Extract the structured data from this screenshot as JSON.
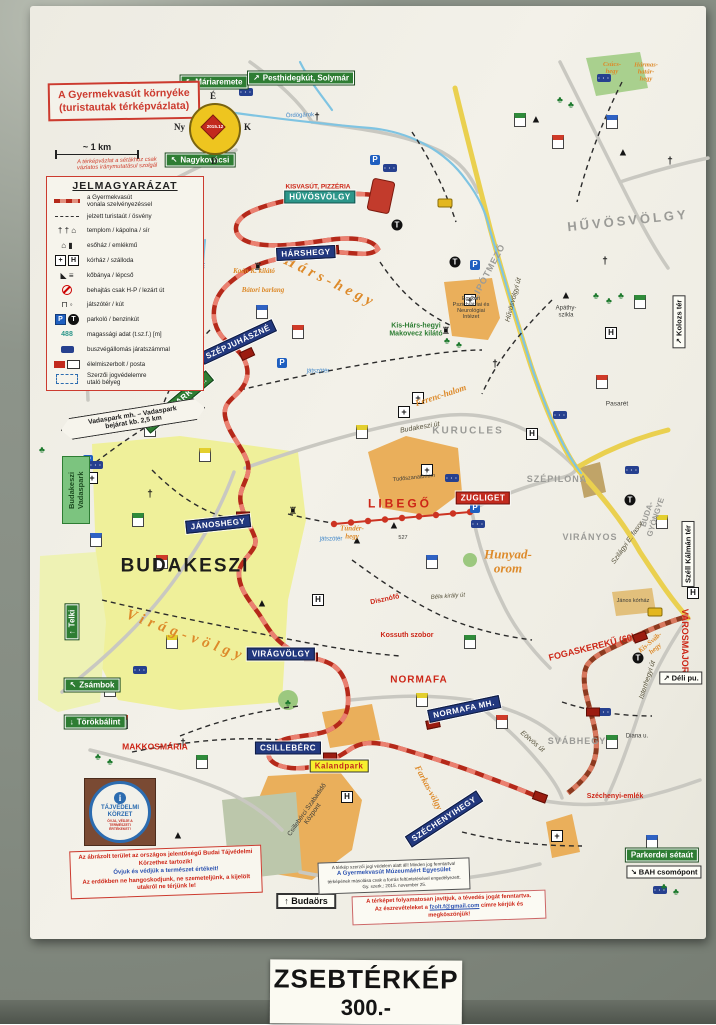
{
  "price": {
    "line1": "ZSEBTÉRKÉP",
    "line2": "300.-"
  },
  "title_box": {
    "line1": "A Gyermekvasút környéke",
    "line2": "(turistautak térképvázlata)"
  },
  "note": "A térképvázlat a sétákhoz csak\nvázlatos iránymutatásul szolgál",
  "scale_label": "~ 1 km",
  "compass": {
    "n": "É",
    "e": "K",
    "s": "D",
    "w": "Ny",
    "date": "2015.12"
  },
  "legend": {
    "title": "JELMAGYARÁZAT",
    "items": [
      {
        "type": "rail",
        "label": "a Gyermekvasút\nvonala szelvényezéssel"
      },
      {
        "type": "trail",
        "label": "jelzett turistaút / ösvény"
      },
      {
        "type": "church",
        "label": "templom / kápolna / sír"
      },
      {
        "type": "shelter",
        "label": "esőház / emlékmű"
      },
      {
        "type": "hospital",
        "label": "kórház / szálloda"
      },
      {
        "type": "quarry",
        "label": "kőbánya / lépcső"
      },
      {
        "type": "restricted",
        "label": "behajtás csak H-P / lezárt út"
      },
      {
        "type": "playground",
        "label": "játszótér / kút"
      },
      {
        "type": "parking",
        "label": "parkoló / benzinkút"
      },
      {
        "type": "elevation",
        "sample": "488",
        "label": "magassági adat (t.sz.f.) [m]"
      },
      {
        "type": "bus",
        "label": "buszvégállomás járatszámmal"
      },
      {
        "type": "shop",
        "label": "élelmiszerbolt / posta"
      },
      {
        "type": "stamp",
        "label": "Szerzői jogvédelemre\nutaló bélyeg"
      }
    ]
  },
  "callout": "Vadaspark mh. – Vadaspark\nbejárat kb. 2,5 km",
  "vadaspark_sign": "Budakeszi\nVadaspark",
  "stations": [
    {
      "t": "HŰVÖSVÖLGY",
      "x": 320,
      "y": 197,
      "v": "teal"
    },
    {
      "t": "HÁRSHEGY",
      "x": 306,
      "y": 253,
      "r": -3
    },
    {
      "t": "SZÉPJUHÁSZNÉ",
      "x": 238,
      "y": 342,
      "r": -25
    },
    {
      "t": "VADASPARK MH.",
      "x": 178,
      "y": 402,
      "r": -40,
      "v": "green"
    },
    {
      "t": "JÁNOSHEGY",
      "x": 218,
      "y": 524,
      "r": -6
    },
    {
      "t": "VIRÁGVÖLGY",
      "x": 281,
      "y": 654
    },
    {
      "t": "NORMAFA MH.",
      "x": 464,
      "y": 709,
      "r": -12
    },
    {
      "t": "CSILLEBÉRC",
      "x": 288,
      "y": 748
    },
    {
      "t": "SZÉCHENYIHEGY",
      "x": 444,
      "y": 819,
      "r": -33
    },
    {
      "t": "ZUGLIGET",
      "x": 483,
      "y": 498,
      "v": "red"
    },
    {
      "t": "Kalandpark",
      "x": 339,
      "y": 766,
      "v": "yellow"
    }
  ],
  "green_signs": [
    {
      "t": "Máriaremete",
      "a": "↖",
      "x": 214,
      "y": 82
    },
    {
      "t": "Pesthidegkút, Solymár",
      "a": "↗",
      "x": 301,
      "y": 78
    },
    {
      "t": "Nagykovácsi",
      "a": "↖",
      "x": 200,
      "y": 160
    },
    {
      "t": "Telki",
      "a": "↑",
      "x": 72,
      "y": 622,
      "r": -90
    },
    {
      "t": "Zsámbok",
      "a": "↖",
      "x": 92,
      "y": 685
    },
    {
      "t": "Törökbálint",
      "a": "↓",
      "x": 95,
      "y": 722
    },
    {
      "t": "Parkerdei sétaút",
      "a": "",
      "x": 662,
      "y": 855
    }
  ],
  "white_signs": [
    {
      "t": "Kolozs tér",
      "a": "↗",
      "x": 679,
      "y": 322,
      "r": -90
    },
    {
      "t": "Széll Kálmán tér",
      "a": "",
      "x": 688,
      "y": 554,
      "r": -90
    },
    {
      "t": "Déli pu.",
      "a": "↗",
      "x": 681,
      "y": 678
    },
    {
      "t": "BAH csomópont",
      "a": "↘",
      "x": 664,
      "y": 872
    },
    {
      "t": "Budaörs",
      "a": "↑",
      "x": 306,
      "y": 901,
      "v": "strong"
    }
  ],
  "labels": [
    {
      "t": "HŰVÖSVÖLGY",
      "x": 628,
      "y": 221,
      "c": "gray",
      "s": 13,
      "r": -6,
      "ls": 3
    },
    {
      "t": "LIPÓTMEZŐ",
      "x": 489,
      "y": 272,
      "c": "gray",
      "s": 9,
      "r": -62,
      "ls": 1
    },
    {
      "t": "KURUCLES",
      "x": 468,
      "y": 431,
      "c": "gray",
      "s": 10,
      "ls": 2
    },
    {
      "t": "SZÉPILONA",
      "x": 557,
      "y": 480,
      "c": "gray",
      "s": 9,
      "ls": 1
    },
    {
      "t": "VIRÁNYOS",
      "x": 590,
      "y": 538,
      "c": "gray",
      "s": 9,
      "ls": 1
    },
    {
      "t": "SVÁBHEGY",
      "x": 577,
      "y": 742,
      "c": "gray",
      "s": 9,
      "ls": 1
    },
    {
      "t": "BUDA-\nGYÖNGYE",
      "x": 652,
      "y": 516,
      "c": "gray",
      "s": 8,
      "r": -72
    },
    {
      "t": "BUDAKESZI",
      "x": 185,
      "y": 567,
      "c": "big",
      "s": 19,
      "ls": 2
    },
    {
      "t": "Hárs-hegy",
      "x": 330,
      "y": 282,
      "c": "orange",
      "s": 15,
      "r": 26,
      "ls": 4
    },
    {
      "t": "Virág-völgy",
      "x": 186,
      "y": 636,
      "c": "orange",
      "s": 15,
      "r": 20,
      "ls": 5
    },
    {
      "t": "Hunyad-\norom",
      "x": 508,
      "y": 562,
      "c": "orange",
      "s": 13
    },
    {
      "t": "Ferenc-halom",
      "x": 441,
      "y": 396,
      "c": "orange",
      "s": 9,
      "r": -18
    },
    {
      "t": "Kis-Sváb-\nhegy",
      "x": 653,
      "y": 646,
      "c": "orange",
      "s": 7,
      "r": -40
    },
    {
      "t": "Tündér-\nhegy",
      "x": 352,
      "y": 533,
      "c": "orange",
      "s": 7
    },
    {
      "t": "Farkas-völgy",
      "x": 428,
      "y": 788,
      "c": "orange",
      "s": 9,
      "r": 62
    },
    {
      "t": "Csúcs-\nhegy",
      "x": 612,
      "y": 68,
      "c": "orange",
      "s": 6.5
    },
    {
      "t": "Hármas-\nhatár-\nhegy",
      "x": 646,
      "y": 72,
      "c": "orange",
      "s": 6.5
    },
    {
      "t": "Kaán K. kilátó",
      "x": 254,
      "y": 272,
      "c": "orange",
      "s": 7
    },
    {
      "t": "Bátori barlang",
      "x": 263,
      "y": 291,
      "c": "orange",
      "s": 7
    },
    {
      "t": "Kis-Hárs-hegyi\nMakovecz kilátó",
      "x": 416,
      "y": 330,
      "c": "green",
      "s": 7
    },
    {
      "t": "KISVASÚT, PIZZÉRIA",
      "x": 318,
      "y": 187,
      "c": "red",
      "s": 6.5
    },
    {
      "t": "LIBEGŐ",
      "x": 400,
      "y": 504,
      "c": "red",
      "s": 12,
      "ls": 3
    },
    {
      "t": "FOGASKEREKŰ (60)",
      "x": 592,
      "y": 648,
      "c": "red",
      "s": 9,
      "r": -14
    },
    {
      "t": "VÁROSMAJOR",
      "x": 684,
      "y": 641,
      "c": "red",
      "s": 9,
      "r": 90
    },
    {
      "t": "NORMAFA",
      "x": 419,
      "y": 680,
      "c": "red",
      "s": 10,
      "ls": 1
    },
    {
      "t": "MAKKOSMÁRIA",
      "x": 155,
      "y": 747,
      "c": "red",
      "s": 8.5
    },
    {
      "t": "Kossuth szobor",
      "x": 407,
      "y": 636,
      "c": "red",
      "s": 7
    },
    {
      "t": "Disznófő",
      "x": 385,
      "y": 600,
      "c": "red",
      "s": 7,
      "r": -12
    },
    {
      "t": "Széchenyi-emlék",
      "x": 615,
      "y": 797,
      "c": "red",
      "s": 7
    },
    {
      "t": "Tüdőszanatórium",
      "x": 414,
      "y": 478,
      "c": "dark",
      "s": 5.5,
      "r": -6
    },
    {
      "t": "Csillebérci Szabadidő\nKözpont",
      "x": 310,
      "y": 812,
      "c": "dark",
      "s": 6.5,
      "r": -55
    },
    {
      "t": "Egykori\nPszichiátriai és\nNeurológiai\nIntézet",
      "x": 471,
      "y": 308,
      "c": "dark",
      "s": 5.5
    },
    {
      "t": "Apáthy-\nszikla",
      "x": 566,
      "y": 312,
      "c": "dark",
      "s": 6
    },
    {
      "t": "Pasarét",
      "x": 617,
      "y": 404,
      "c": "dark",
      "s": 6.5
    },
    {
      "t": "János kórház",
      "x": 633,
      "y": 601,
      "c": "dark",
      "s": 5.5
    },
    {
      "t": "Diana u.",
      "x": 637,
      "y": 737,
      "c": "dark",
      "s": 6
    },
    {
      "t": "527",
      "x": 403,
      "y": 538,
      "c": "dark",
      "s": 5.5
    },
    {
      "t": "Ördögárok",
      "x": 300,
      "y": 116,
      "c": "blue",
      "s": 6,
      "r": -2
    },
    {
      "t": "Kis-Ördögárok",
      "x": 201,
      "y": 282,
      "c": "blue",
      "s": 6,
      "r": -80
    },
    {
      "t": "játszótér",
      "x": 318,
      "y": 372,
      "c": "blue",
      "s": 6
    },
    {
      "t": "játszótér",
      "x": 331,
      "y": 540,
      "c": "blue",
      "s": 6
    },
    {
      "t": "Hűvösvölgyi út",
      "x": 514,
      "y": 300,
      "c": "road",
      "s": 7,
      "r": -75
    },
    {
      "t": "Szilágyi E. fasor",
      "x": 628,
      "y": 543,
      "c": "road",
      "s": 7,
      "r": -55
    },
    {
      "t": "Budakeszi út",
      "x": 420,
      "y": 428,
      "c": "road",
      "s": 7,
      "r": -10
    },
    {
      "t": "Istenhegyi út",
      "x": 648,
      "y": 680,
      "c": "road",
      "s": 7,
      "r": -72
    },
    {
      "t": "Eötvös út",
      "x": 532,
      "y": 742,
      "c": "road",
      "s": 7,
      "r": 40
    },
    {
      "t": "Béla király út",
      "x": 448,
      "y": 597,
      "c": "road",
      "s": 6,
      "r": -4
    }
  ],
  "icons": [
    {
      "k": "hospital",
      "g": "+",
      "x": 418,
      "y": 398
    },
    {
      "k": "hospital",
      "g": "+",
      "x": 404,
      "y": 412
    },
    {
      "k": "hospital",
      "g": "+",
      "x": 427,
      "y": 470
    },
    {
      "k": "hospital",
      "g": "+",
      "x": 470,
      "y": 300
    },
    {
      "k": "hospital",
      "g": "+",
      "x": 92,
      "y": 478
    },
    {
      "k": "hospital",
      "g": "+",
      "x": 557,
      "y": 836
    },
    {
      "k": "hotel",
      "g": "H",
      "x": 318,
      "y": 600
    },
    {
      "k": "hotel",
      "g": "H",
      "x": 532,
      "y": 434
    },
    {
      "k": "hotel",
      "g": "H",
      "x": 347,
      "y": 797
    },
    {
      "k": "hotel",
      "g": "H",
      "x": 611,
      "y": 333
    },
    {
      "k": "hotel",
      "g": "H",
      "x": 693,
      "y": 593
    },
    {
      "k": "parking",
      "g": "P",
      "x": 375,
      "y": 160
    },
    {
      "k": "parking",
      "g": "P",
      "x": 282,
      "y": 363
    },
    {
      "k": "parking",
      "g": "P",
      "x": 88,
      "y": 460
    },
    {
      "k": "parking",
      "g": "P",
      "x": 475,
      "y": 508
    },
    {
      "k": "parking",
      "g": "P",
      "x": 475,
      "y": 265
    },
    {
      "k": "fuel",
      "g": "T",
      "x": 397,
      "y": 225
    },
    {
      "k": "fuel",
      "g": "T",
      "x": 455,
      "y": 262
    },
    {
      "k": "fuel",
      "g": "T",
      "x": 630,
      "y": 500
    },
    {
      "k": "fuel",
      "g": "T",
      "x": 638,
      "y": 658
    },
    {
      "k": "bus",
      "g": "",
      "x": 246,
      "y": 92
    },
    {
      "k": "bus",
      "g": "",
      "x": 390,
      "y": 168
    },
    {
      "k": "bus",
      "g": "",
      "x": 452,
      "y": 478
    },
    {
      "k": "bus",
      "g": "",
      "x": 478,
      "y": 524
    },
    {
      "k": "bus",
      "g": "",
      "x": 560,
      "y": 415
    },
    {
      "k": "bus",
      "g": "",
      "x": 632,
      "y": 470
    },
    {
      "k": "bus",
      "g": "",
      "x": 604,
      "y": 78
    },
    {
      "k": "bus",
      "g": "",
      "x": 96,
      "y": 465
    },
    {
      "k": "bus",
      "g": "",
      "x": 140,
      "y": 670
    },
    {
      "k": "bus",
      "g": "",
      "x": 342,
      "y": 882
    },
    {
      "k": "bus",
      "g": "",
      "x": 604,
      "y": 712
    },
    {
      "k": "bus",
      "g": "",
      "x": 660,
      "y": 890
    },
    {
      "k": "tram",
      "g": "",
      "x": 445,
      "y": 203
    },
    {
      "k": "tram",
      "g": "",
      "x": 655,
      "y": 612
    },
    {
      "k": "church",
      "g": "†",
      "x": 317,
      "y": 118
    },
    {
      "k": "church",
      "g": "†",
      "x": 150,
      "y": 495
    },
    {
      "k": "church",
      "g": "†",
      "x": 183,
      "y": 744
    },
    {
      "k": "church",
      "g": "†",
      "x": 605,
      "y": 262
    },
    {
      "k": "church",
      "g": "†",
      "x": 495,
      "y": 365
    },
    {
      "k": "church",
      "g": "†",
      "x": 670,
      "y": 162
    },
    {
      "k": "peak",
      "g": "▲",
      "x": 394,
      "y": 526
    },
    {
      "k": "peak",
      "g": "▲",
      "x": 357,
      "y": 541
    },
    {
      "k": "peak",
      "g": "▲",
      "x": 566,
      "y": 296
    },
    {
      "k": "peak",
      "g": "▲",
      "x": 262,
      "y": 604
    },
    {
      "k": "peak",
      "g": "▲",
      "x": 623,
      "y": 153
    },
    {
      "k": "peak",
      "g": "▲",
      "x": 178,
      "y": 836
    },
    {
      "k": "peak",
      "g": "▲",
      "x": 536,
      "y": 120
    },
    {
      "k": "tower",
      "g": "♜",
      "x": 293,
      "y": 512
    },
    {
      "k": "tower",
      "g": "♜",
      "x": 258,
      "y": 268
    },
    {
      "k": "tower",
      "g": "♜",
      "x": 446,
      "y": 332
    },
    {
      "k": "tree",
      "g": "♣",
      "x": 596,
      "y": 296
    },
    {
      "k": "tree",
      "g": "♣",
      "x": 609,
      "y": 301
    },
    {
      "k": "tree",
      "g": "♣",
      "x": 621,
      "y": 296
    },
    {
      "k": "tree",
      "g": "♣",
      "x": 447,
      "y": 341
    },
    {
      "k": "tree",
      "g": "♣",
      "x": 459,
      "y": 345
    },
    {
      "k": "tree",
      "g": "♣",
      "x": 42,
      "y": 450
    },
    {
      "k": "tree",
      "g": "♣",
      "x": 98,
      "y": 757
    },
    {
      "k": "tree",
      "g": "♣",
      "x": 110,
      "y": 762
    },
    {
      "k": "tree",
      "g": "♣",
      "x": 288,
      "y": 703
    },
    {
      "k": "tree",
      "g": "♣",
      "x": 664,
      "y": 887
    },
    {
      "k": "tree",
      "g": "♣",
      "x": 676,
      "y": 892
    },
    {
      "k": "tree",
      "g": "♣",
      "x": 560,
      "y": 100
    },
    {
      "k": "tree",
      "g": "♣",
      "x": 571,
      "y": 105
    },
    {
      "k": "tree",
      "g": "♣",
      "x": 358,
      "y": 866
    }
  ],
  "flags": [
    {
      "x": 150,
      "y": 430,
      "c": "#d03a28"
    },
    {
      "x": 205,
      "y": 455,
      "c": "#e3cf2e"
    },
    {
      "x": 138,
      "y": 520,
      "c": "#2f8b3a"
    },
    {
      "x": 162,
      "y": 562,
      "c": "#d03a28"
    },
    {
      "x": 96,
      "y": 540,
      "c": "#2f62c4"
    },
    {
      "x": 520,
      "y": 120,
      "c": "#2f8b3a"
    },
    {
      "x": 558,
      "y": 142,
      "c": "#d03a28"
    },
    {
      "x": 612,
      "y": 122,
      "c": "#2f62c4"
    },
    {
      "x": 640,
      "y": 302,
      "c": "#2f8b3a"
    },
    {
      "x": 602,
      "y": 382,
      "c": "#d03a28"
    },
    {
      "x": 662,
      "y": 522,
      "c": "#e3cf2e"
    },
    {
      "x": 470,
      "y": 642,
      "c": "#2f8b3a"
    },
    {
      "x": 432,
      "y": 562,
      "c": "#2f62c4"
    },
    {
      "x": 362,
      "y": 432,
      "c": "#e3cf2e"
    },
    {
      "x": 298,
      "y": 332,
      "c": "#d03a28"
    },
    {
      "x": 262,
      "y": 312,
      "c": "#2f62c4"
    },
    {
      "x": 172,
      "y": 642,
      "c": "#e3cf2e"
    },
    {
      "x": 122,
      "y": 722,
      "c": "#d03a28"
    },
    {
      "x": 202,
      "y": 762,
      "c": "#2f8b3a"
    },
    {
      "x": 422,
      "y": 700,
      "c": "#e3cf2e"
    },
    {
      "x": 502,
      "y": 722,
      "c": "#d03a28"
    },
    {
      "x": 612,
      "y": 742,
      "c": "#2f8b3a"
    },
    {
      "x": 652,
      "y": 842,
      "c": "#2f62c4"
    },
    {
      "x": 110,
      "y": 690,
      "c": "#e3cf2e"
    }
  ],
  "station_blocks": [
    {
      "x": 332,
      "y": 250,
      "r": -5
    },
    {
      "x": 247,
      "y": 354,
      "r": -25
    },
    {
      "x": 243,
      "y": 516
    },
    {
      "x": 311,
      "y": 657
    },
    {
      "x": 433,
      "y": 724,
      "r": -12
    },
    {
      "x": 330,
      "y": 757
    },
    {
      "x": 540,
      "y": 797,
      "r": 20
    },
    {
      "x": 593,
      "y": 712
    },
    {
      "x": 640,
      "y": 637,
      "r": -20
    }
  ],
  "info_box": {
    "l1": "A térkép szerzői jogi védelem alatt áll! Minden jog fenntartva!",
    "l2": "A Gyermekvasút Múzeumáért Egyesület",
    "l3": "térképének másolása csak a forrás feltüntetésével engedélyezett.",
    "l4": "Gy. szerk.: 2015. november 25."
  },
  "feedback_box": {
    "l1": "A térképet folyamatosan javítjuk, a tévedés jogát fenntartva.",
    "l2a": "Az észrevételeket a ",
    "email": "fzolt.f@gmail.com",
    "l2b": " címre kérjük és megköszönjük!"
  },
  "protect_box": {
    "l1": "Az ábrázolt terület az országos jelentőségű Budai Tájvédelmi Körzethez tartozik!",
    "l2": "Óvjuk és védjük a természet értékeit!",
    "l3": "Az erdőkben ne hangoskodjunk, ne szemeteljünk, a kijelölt utakról ne térjünk le!"
  },
  "protect_sign": {
    "title": "TÁJVÉDELMI\nKÖRZET",
    "sub": "ÓVJA, VÉDJE A\nTERMÉSZETI\nÉRTÉKEKET!"
  },
  "colors": {
    "railway": "#b5291a",
    "railway_light": "#ea8070",
    "cog": "#8d3a20",
    "chairlift": "#cc3322",
    "station_navy": "#22387e",
    "station_teal": "#2c968a",
    "sign_green": "#2e7d33",
    "road_yellow": "#ead04f",
    "water": "#7fc4e2",
    "town_yellow": "#eff09a",
    "building_orange": "#eaaf5b"
  }
}
